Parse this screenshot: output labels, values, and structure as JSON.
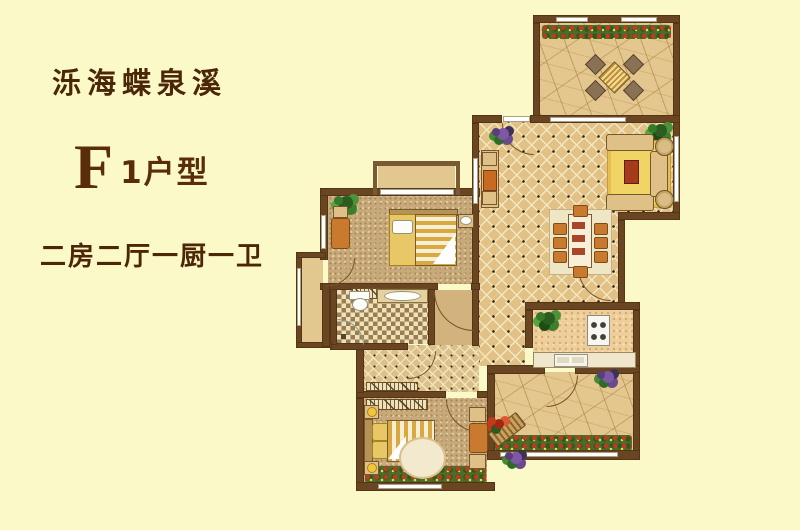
{
  "header": {
    "project_name": "泺海蝶泉溪",
    "unit_letter": "F",
    "unit_suffix": "1户型",
    "layout_description": "二房二厅一厨一卫"
  },
  "palette": {
    "bg": "#fcf9c9",
    "ink": "#4b2708",
    "wall": "#6a4522",
    "tile": "#e1c186",
    "stone": "#e4c78e",
    "tan": "#dfc187",
    "orange": "#c97a2f",
    "red": "#a63a1c"
  },
  "floorplan": {
    "rooms": [
      {
        "id": "top-terrace"
      },
      {
        "id": "living-dining-room"
      },
      {
        "id": "kitchen"
      },
      {
        "id": "garden-terrace"
      },
      {
        "id": "master-bedroom"
      },
      {
        "id": "second-bedroom"
      },
      {
        "id": "bathroom"
      },
      {
        "id": "corridor"
      },
      {
        "id": "small-balcony"
      },
      {
        "id": "side-balcony"
      }
    ]
  }
}
